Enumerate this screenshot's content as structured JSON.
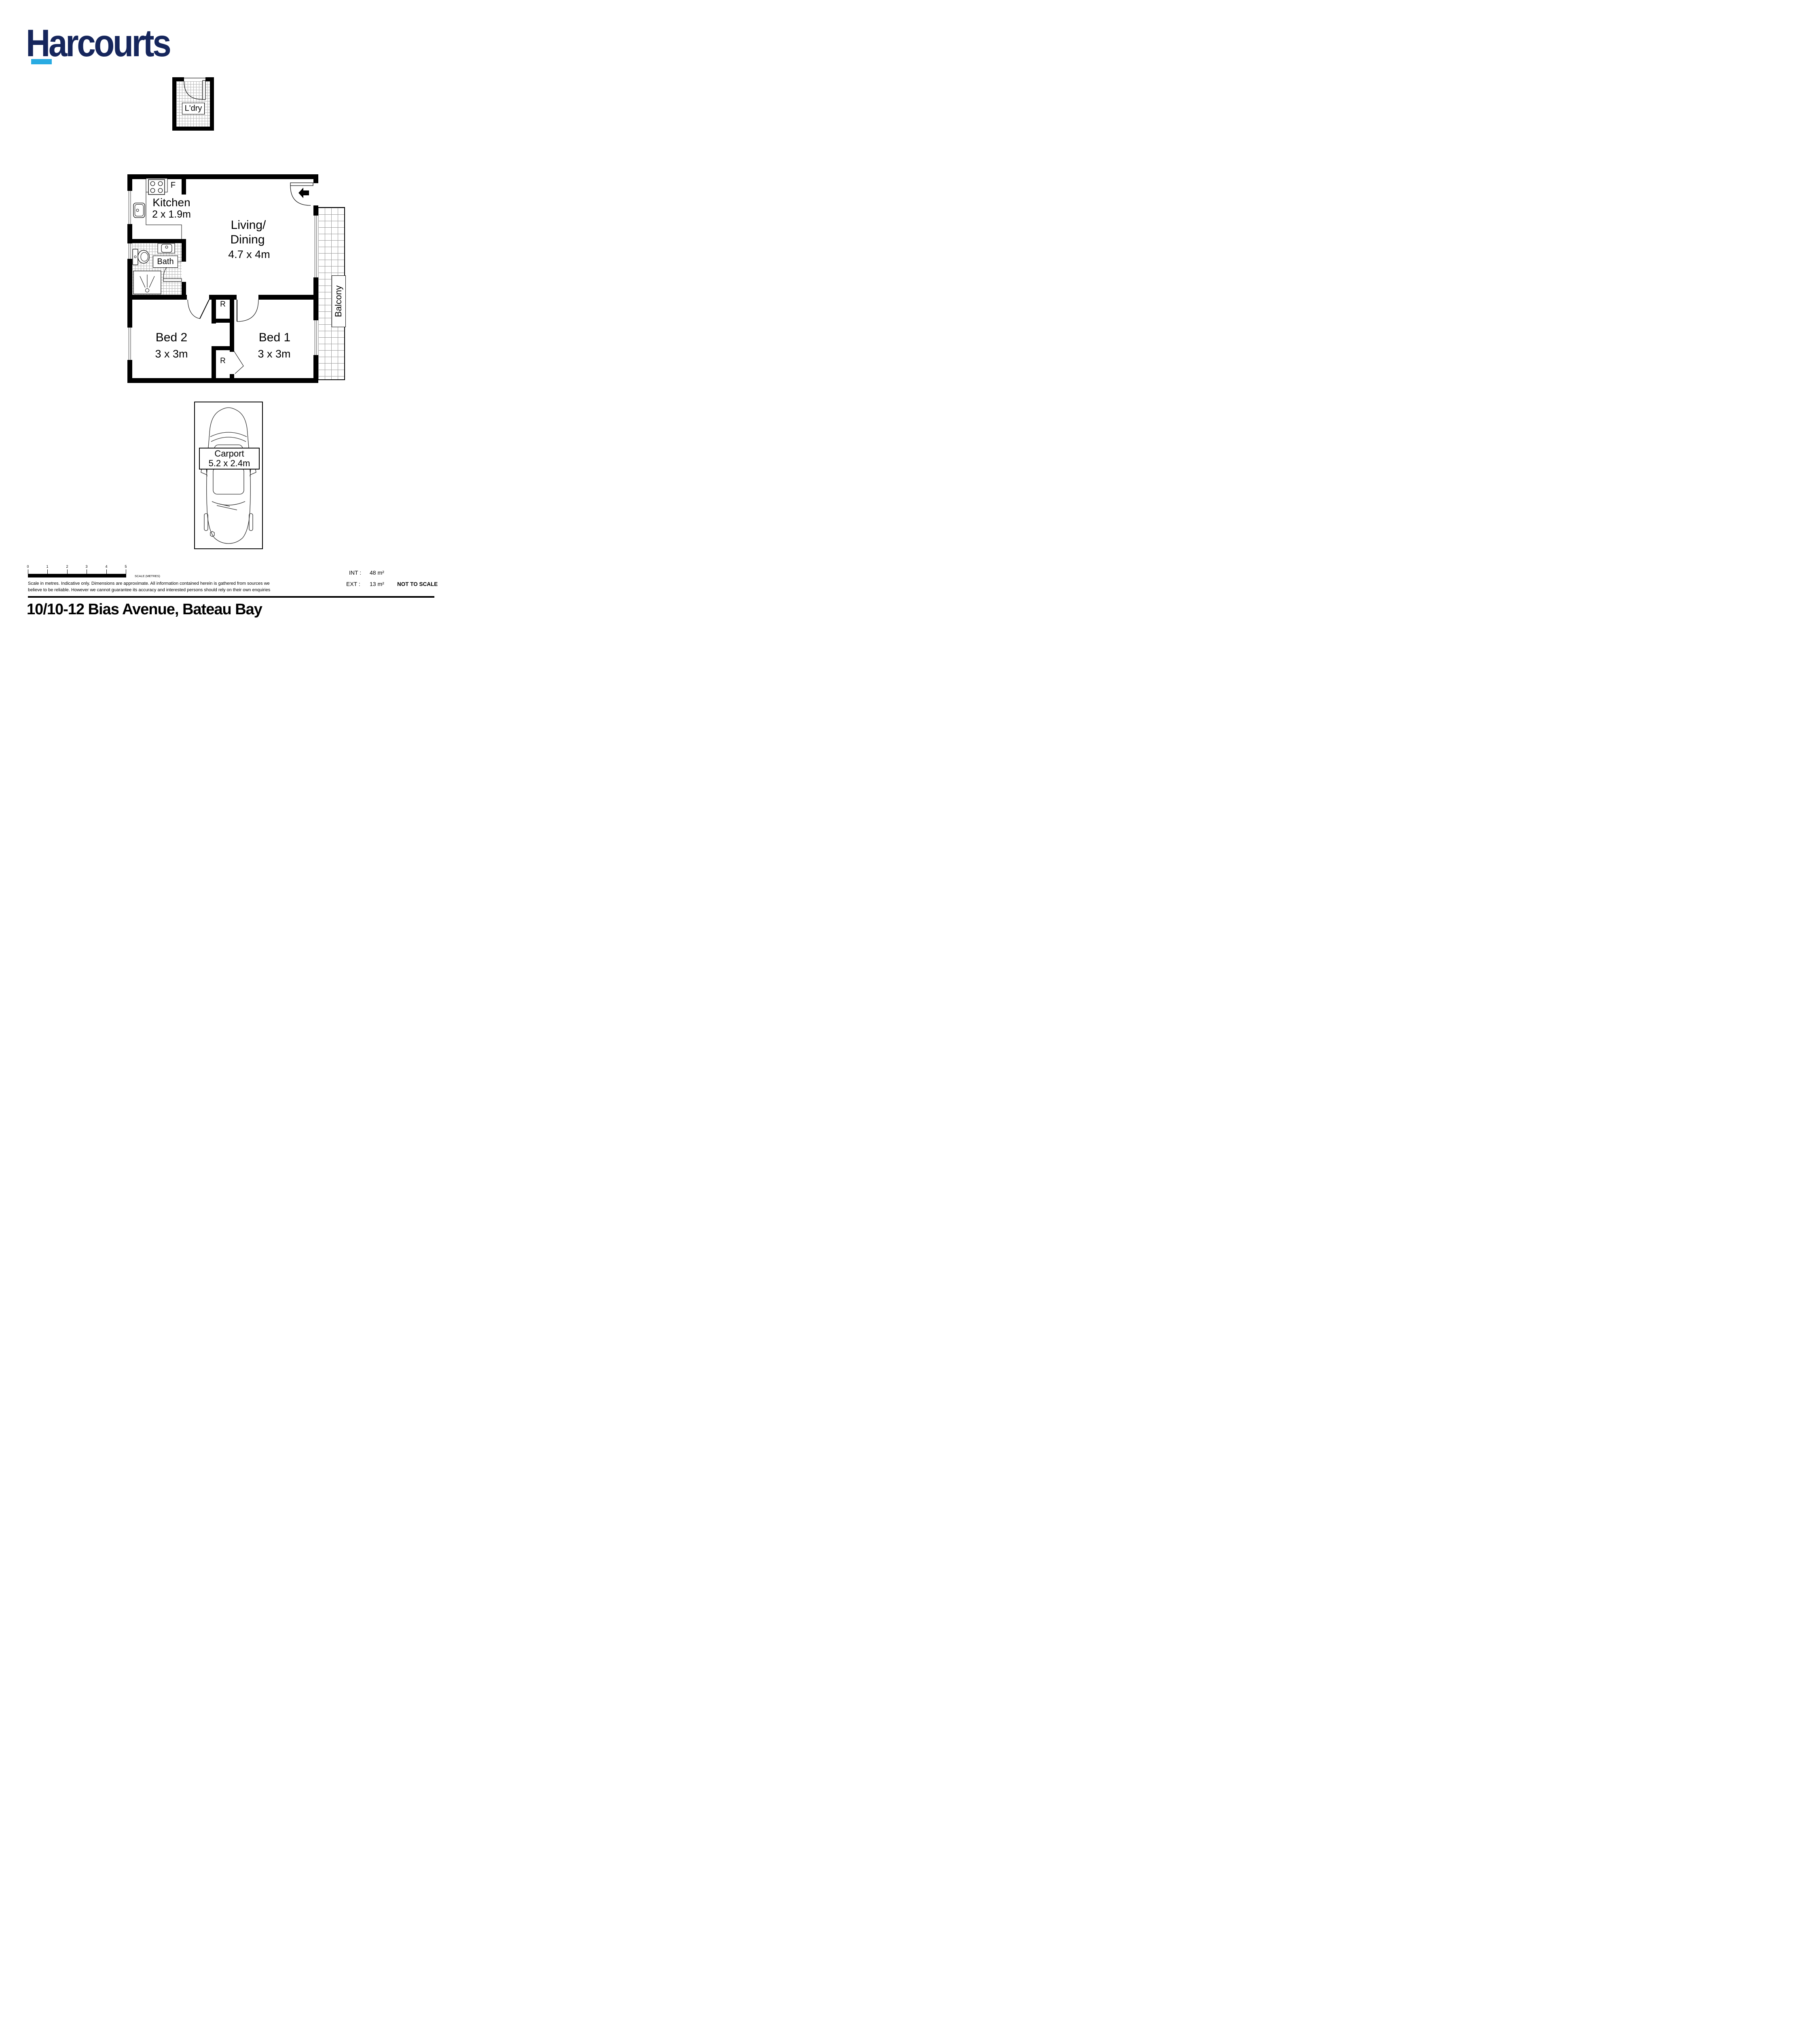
{
  "brand": {
    "name": "Harcourts",
    "navy": "#16265c",
    "cyan": "#29abe2"
  },
  "rooms": {
    "laundry_label": "L'dry",
    "kitchen_label": "Kitchen",
    "kitchen_dims": "2 x 1.9m",
    "living_label_line1": "Living/",
    "living_label_line2": "Dining",
    "living_dims": "4.7 x 4m",
    "bath_label": "Bath",
    "bed2_label": "Bed 2",
    "bed2_dims": "3 x 3m",
    "bed1_label": "Bed 1",
    "bed1_dims": "3 x 3m",
    "balcony_label": "Balcony",
    "carport_label": "Carport",
    "carport_dims": "5.2 x 2.4m",
    "fridge_label": "F",
    "robe_label": "R"
  },
  "scalebar": {
    "ticks": [
      "0",
      "1",
      "2",
      "3",
      "4",
      "5"
    ],
    "label": "SCALE (METRES)"
  },
  "disclaimer": {
    "line1": "Scale in metres. Indicative only. Dimensions are approximate. All information contained herein is gathered from sources we",
    "line2": "believe to be reliable. However we cannot guarantee its accuracy and interested persons should rely on their own enquiries"
  },
  "areas": {
    "int_label": "INT :",
    "int_value": "48 m²",
    "ext_label": "EXT :",
    "ext_value": "13 m²",
    "not_to_scale": "NOT TO SCALE"
  },
  "address": "10/10-12 Bias Avenue, Bateau Bay"
}
